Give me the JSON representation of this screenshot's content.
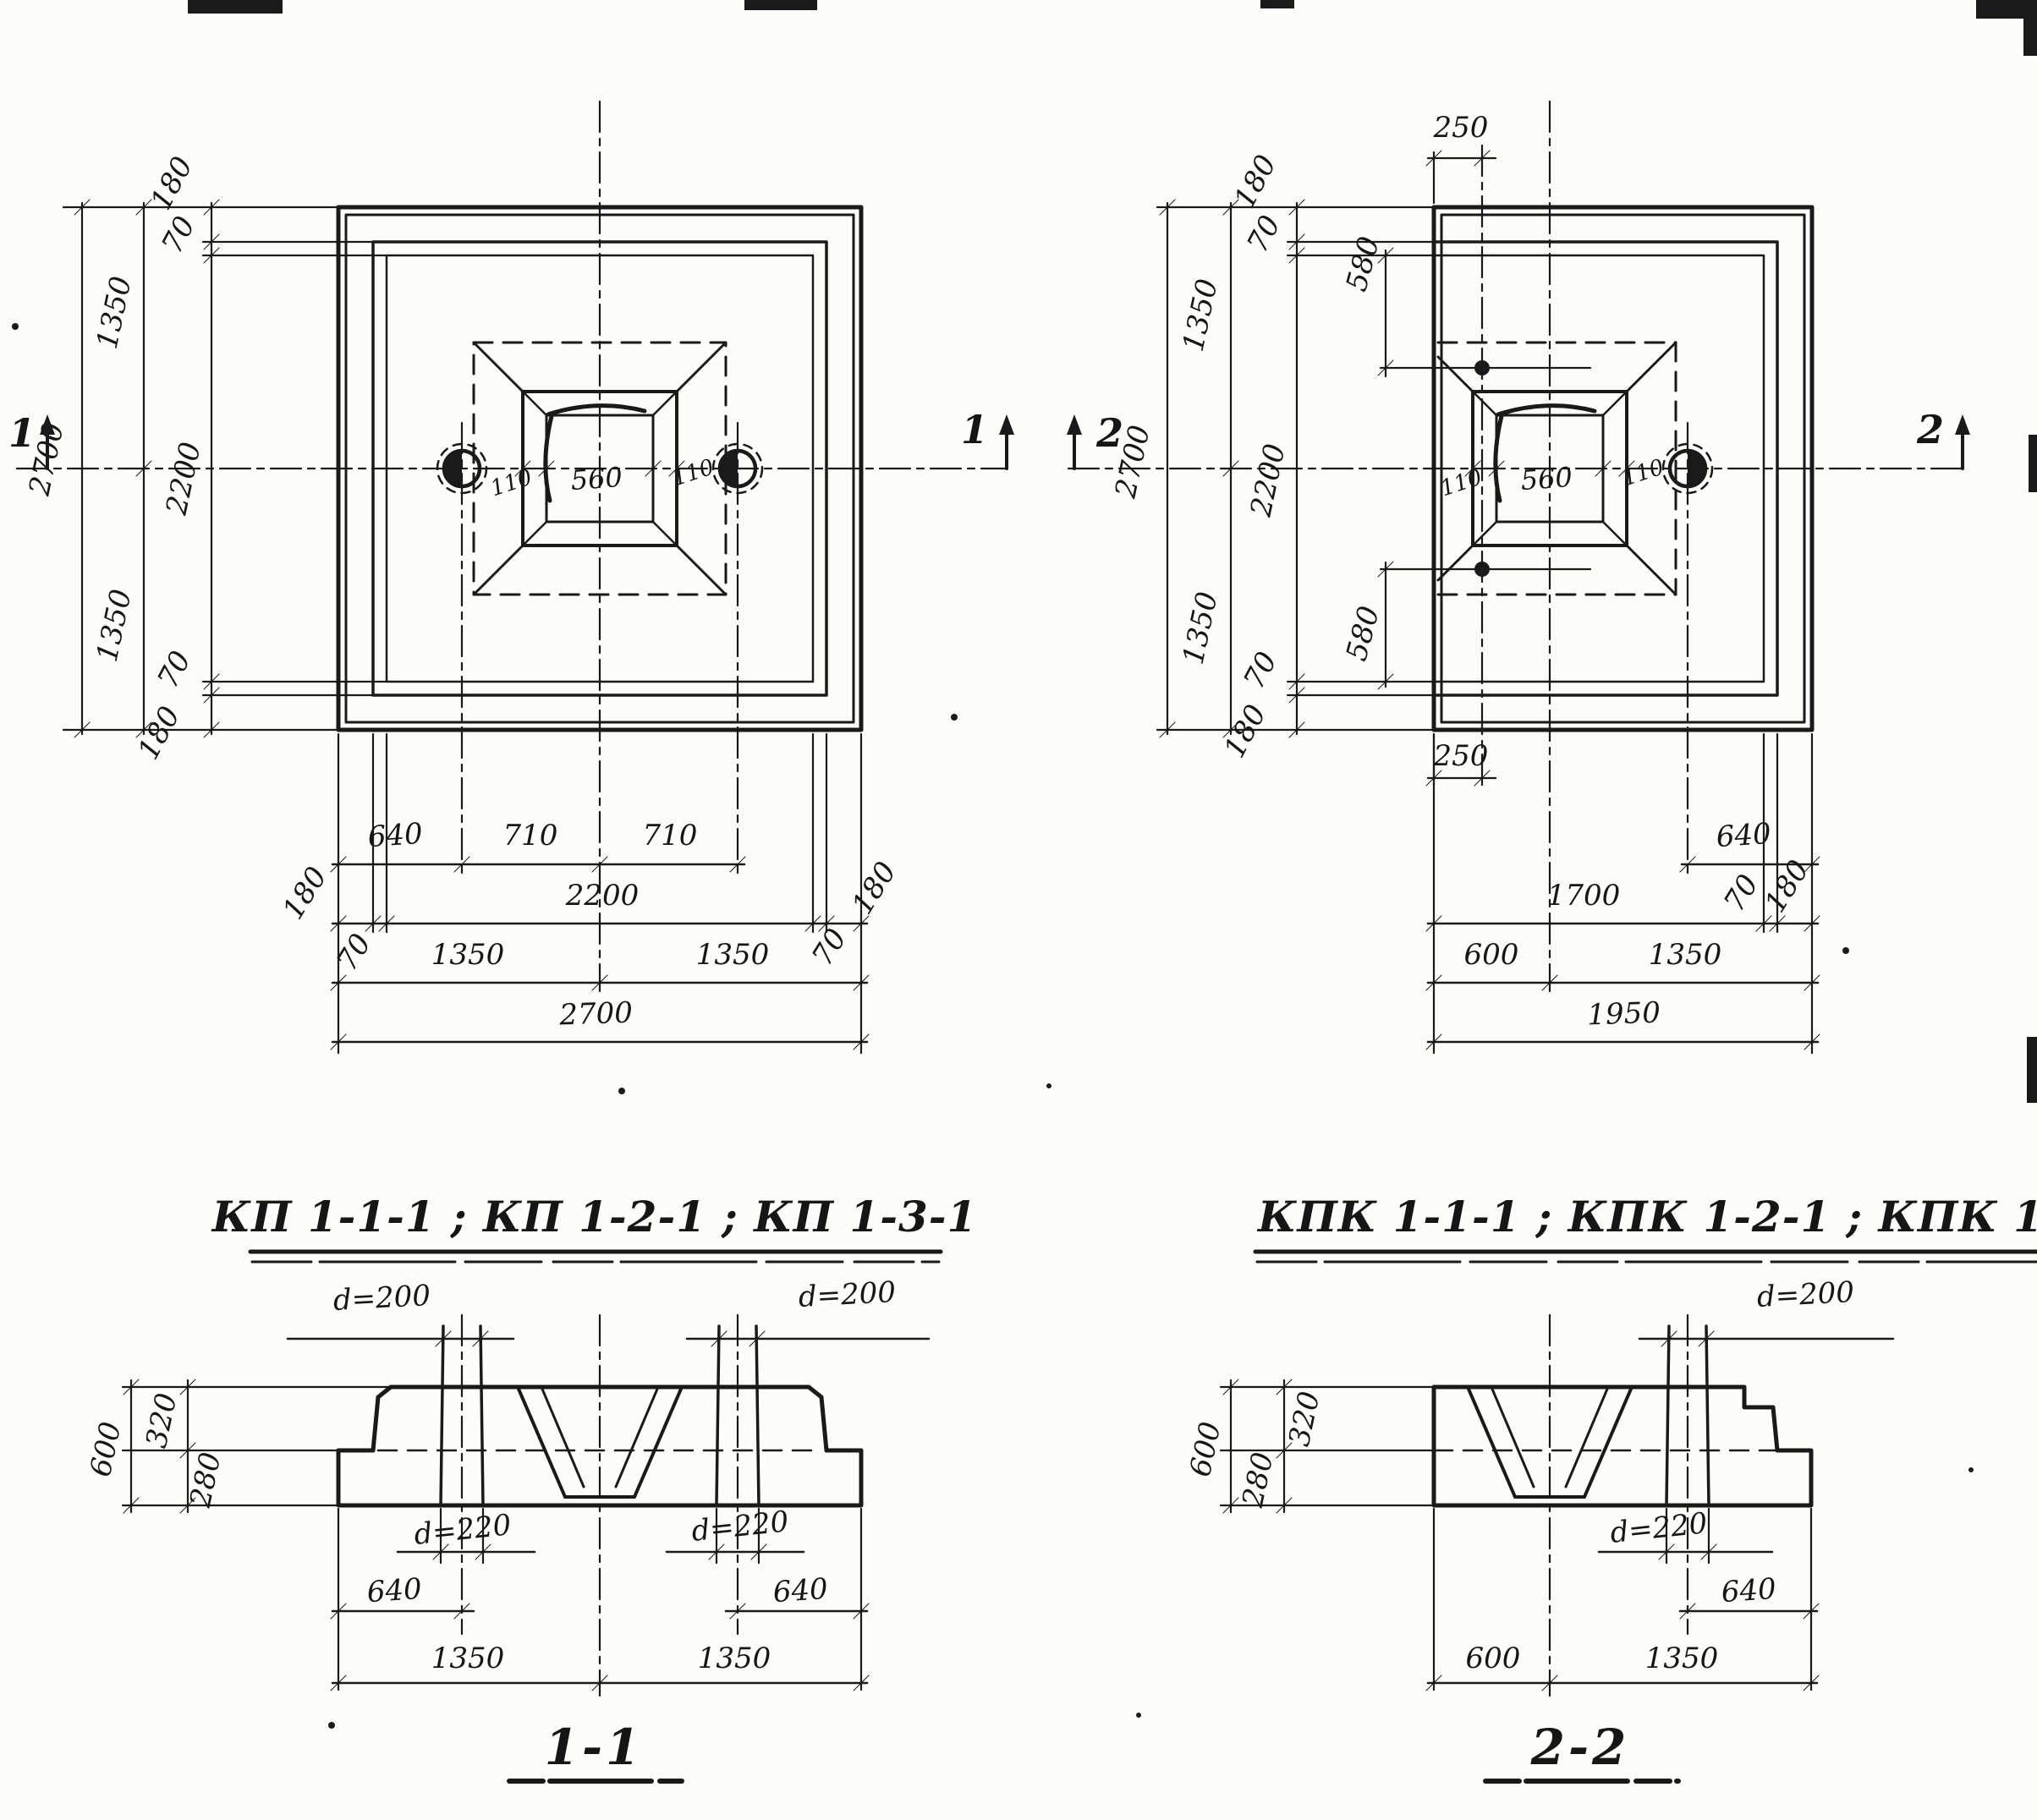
{
  "sheet": {
    "background": "#fcfcf9",
    "ink": "#1a1a1a"
  },
  "left_plan": {
    "title": "КП 1-1-1 ; КП 1-2-1 ; КП 1-3-1",
    "marks": {
      "left": "1",
      "right": "1"
    },
    "cup": {
      "width": "560",
      "wall_left": "110",
      "wall_right": "110"
    },
    "side": {
      "total": "2700",
      "half_top": "1350",
      "half_bottom": "1350",
      "inner": "2200",
      "edge_top": "180",
      "rib_top": "70",
      "rib_bottom": "70",
      "edge_bottom": "180"
    },
    "bottom": {
      "hole_offset": "640",
      "span_left": "710",
      "span_right": "710",
      "edge_left": "180",
      "inner": "2200",
      "edge_right": "180",
      "rib_left": "70",
      "rib_right": "70",
      "half_left": "1350",
      "half_right": "1350",
      "total": "2700"
    }
  },
  "right_plan": {
    "title": "КПК 1-1-1 ; КПК 1-2-1 ; КПК 1-3-1",
    "marks": {
      "left": "2",
      "right": "2"
    },
    "cup": {
      "width": "560",
      "wall_left": "110",
      "wall_right": "110"
    },
    "side": {
      "total": "2700",
      "half_top": "1350",
      "half_bottom": "1350",
      "inner": "2200",
      "edge_top": "180",
      "rib_top": "70",
      "rib_bottom": "70",
      "edge_bottom": "180"
    },
    "anchor_top": {
      "offset": "250",
      "depth": "580"
    },
    "anchor_bottom": {
      "offset": "250",
      "depth": "580"
    },
    "bottom": {
      "hole_offset": "640",
      "inner": "1700",
      "rib": "70",
      "edge": "180",
      "cut_half": "600",
      "half": "1350",
      "total": "1950"
    }
  },
  "section_1": {
    "title": "1-1",
    "hole_top_left": "d=200",
    "hole_top_right": "d=200",
    "hole_bottom_left": "d=220",
    "hole_bottom_right": "d=220",
    "height_total": "600",
    "height_top": "320",
    "height_bottom": "280",
    "edge_left": "640",
    "edge_right": "640",
    "half_left": "1350",
    "half_right": "1350"
  },
  "section_2": {
    "title": "2-2",
    "hole_top": "d=200",
    "hole_bottom": "d=220",
    "height_total": "600",
    "height_top": "320",
    "height_bottom": "280",
    "edge": "640",
    "cut_half": "600",
    "half": "1350"
  }
}
